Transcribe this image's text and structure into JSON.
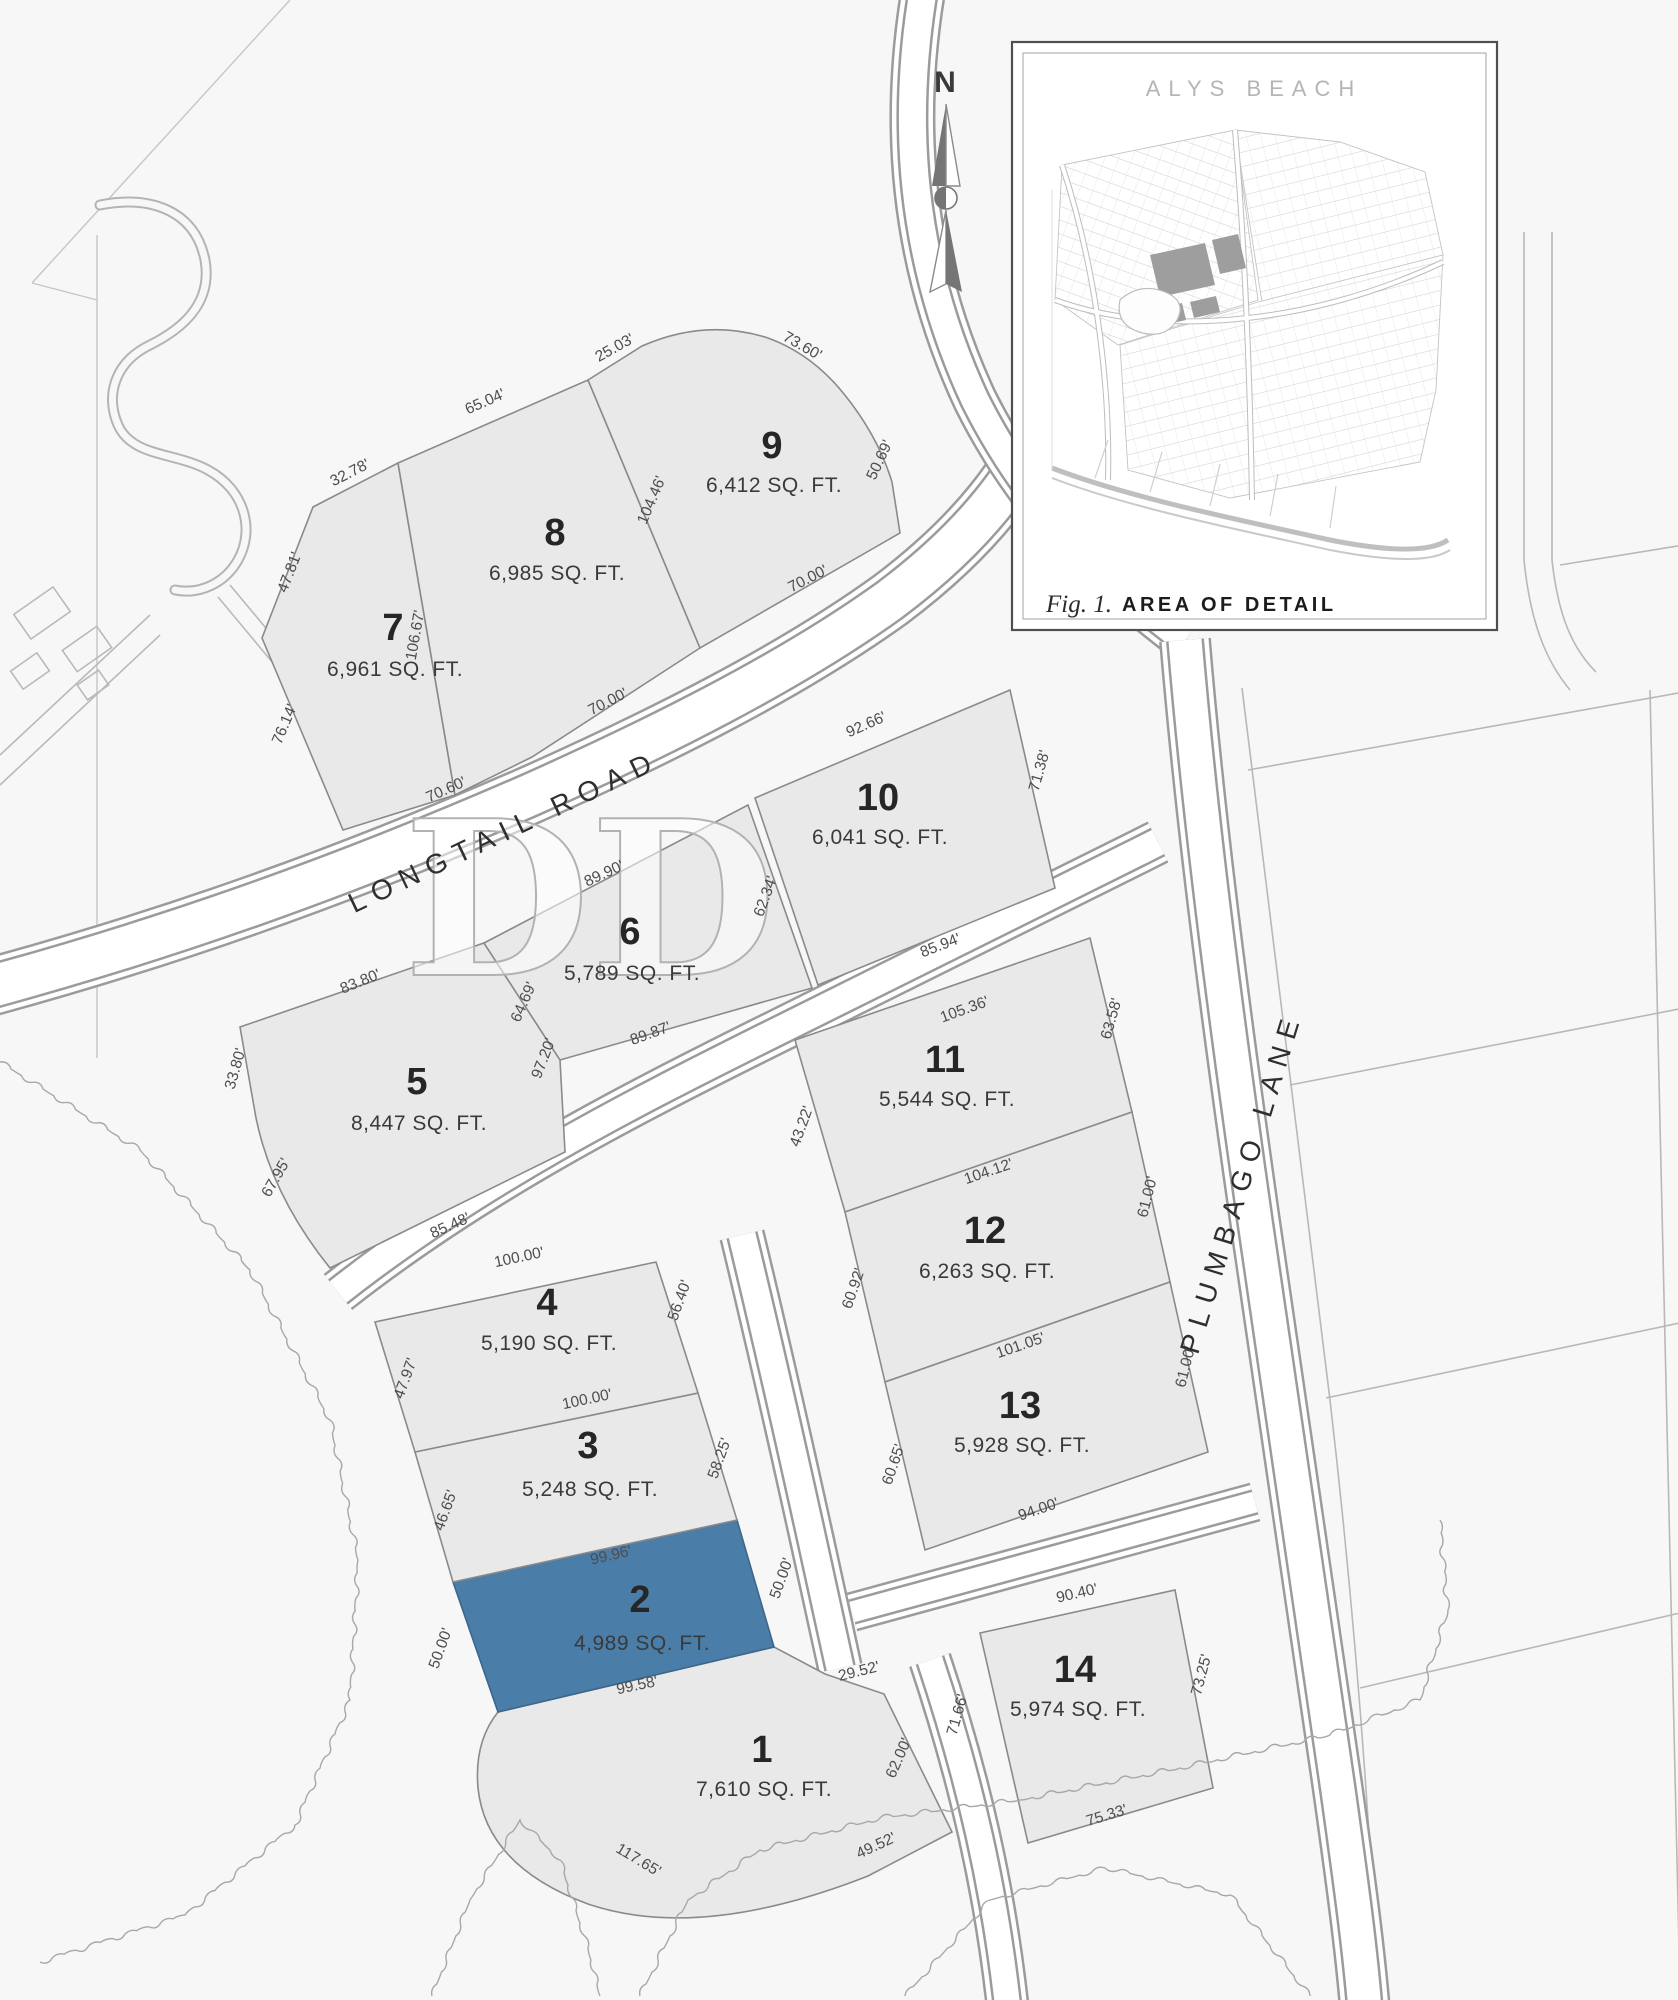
{
  "page": {
    "background": "#f7f7f7"
  },
  "compass": {
    "north_label": "N"
  },
  "watermark": {
    "text": "DD"
  },
  "streets": {
    "longtail": {
      "label": "LONGTAIL ROAD"
    },
    "plumbago": {
      "label": "PLUMBAGO LANE"
    }
  },
  "inset": {
    "title": "ALYS BEACH",
    "figure_label": "Fig. 1.",
    "caption": "AREA OF DETAIL"
  },
  "colors": {
    "highlight": "#4a7da8",
    "lot_fill": "#e9e9e9",
    "lot_stroke": "#8a8a8a",
    "highlight_num": "#20303e",
    "highlight_text": "#3a6080",
    "highlight_dim": "#3f658a"
  },
  "lots": [
    {
      "number": "1",
      "area": "7,610 SQ. FT.",
      "highlighted": false,
      "num_pos": [
        762,
        1762
      ],
      "area_pos": [
        764,
        1796
      ],
      "dims": [
        {
          "text": "117.65'",
          "x": 636,
          "y": 1864,
          "rot": 31
        },
        {
          "text": "49.52'",
          "x": 878,
          "y": 1850,
          "rot": -25
        },
        {
          "text": "62.00'",
          "x": 903,
          "y": 1760,
          "rot": -66
        },
        {
          "text": "29.52'",
          "x": 860,
          "y": 1676,
          "rot": -14
        }
      ]
    },
    {
      "number": "2",
      "area": "4,989 SQ. FT.",
      "highlighted": true,
      "num_pos": [
        640,
        1612
      ],
      "area_pos": [
        642,
        1650
      ],
      "dims": [
        {
          "text": "99.96'",
          "x": 612,
          "y": 1560,
          "rot": -13,
          "color": "#3f658a"
        },
        {
          "text": "50.00'",
          "x": 445,
          "y": 1650,
          "rot": -70,
          "color": "#3f658a"
        },
        {
          "text": "50.00'",
          "x": 786,
          "y": 1580,
          "rot": -70,
          "color": "#3f658a"
        },
        {
          "text": "99.58'",
          "x": 638,
          "y": 1690,
          "rot": -12
        }
      ]
    },
    {
      "number": "3",
      "area": "5,248 SQ. FT.",
      "highlighted": false,
      "num_pos": [
        588,
        1458
      ],
      "area_pos": [
        590,
        1496
      ],
      "dims": [
        {
          "text": "46.65'",
          "x": 450,
          "y": 1512,
          "rot": -70
        },
        {
          "text": "58.25'",
          "x": 724,
          "y": 1460,
          "rot": -70
        }
      ]
    },
    {
      "number": "4",
      "area": "5,190 SQ. FT.",
      "highlighted": false,
      "num_pos": [
        547,
        1315
      ],
      "area_pos": [
        549,
        1350
      ],
      "dims": [
        {
          "text": "100.00'",
          "x": 520,
          "y": 1262,
          "rot": -12
        },
        {
          "text": "47.97'",
          "x": 410,
          "y": 1380,
          "rot": -70
        },
        {
          "text": "100.00'",
          "x": 588,
          "y": 1404,
          "rot": -12
        },
        {
          "text": "56.40'",
          "x": 684,
          "y": 1302,
          "rot": -70
        }
      ]
    },
    {
      "number": "5",
      "area": "8,447 SQ. FT.",
      "highlighted": false,
      "num_pos": [
        417,
        1094
      ],
      "area_pos": [
        419,
        1130
      ],
      "dims": [
        {
          "text": "83.80'",
          "x": 362,
          "y": 986,
          "rot": -22
        },
        {
          "text": "33.80'",
          "x": 240,
          "y": 1070,
          "rot": -74
        },
        {
          "text": "67.95'",
          "x": 280,
          "y": 1180,
          "rot": -60
        },
        {
          "text": "85.48'",
          "x": 452,
          "y": 1230,
          "rot": -24
        },
        {
          "text": "97.20'",
          "x": 548,
          "y": 1060,
          "rot": -69
        }
      ]
    },
    {
      "number": "6",
      "area": "5,789 SQ. FT.",
      "highlighted": false,
      "num_pos": [
        630,
        944
      ],
      "area_pos": [
        632,
        980
      ],
      "dims": [
        {
          "text": "89.90'",
          "x": 606,
          "y": 878,
          "rot": -25
        },
        {
          "text": "64.69'",
          "x": 528,
          "y": 1004,
          "rot": -66
        },
        {
          "text": "89.87'",
          "x": 652,
          "y": 1038,
          "rot": -20
        }
      ]
    },
    {
      "number": "7",
      "area": "6,961 SQ. FT.",
      "highlighted": false,
      "num_pos": [
        393,
        640
      ],
      "area_pos": [
        395,
        676
      ],
      "dims": [
        {
          "text": "47.81'",
          "x": 294,
          "y": 574,
          "rot": -69
        },
        {
          "text": "32.78'",
          "x": 352,
          "y": 477,
          "rot": -27
        },
        {
          "text": "76.14'",
          "x": 289,
          "y": 726,
          "rot": -67
        },
        {
          "text": "70.60'",
          "x": 448,
          "y": 794,
          "rot": -24
        },
        {
          "text": "106.67'",
          "x": 420,
          "y": 636,
          "rot": -80
        }
      ]
    },
    {
      "number": "8",
      "area": "6,985 SQ. FT.",
      "highlighted": false,
      "num_pos": [
        555,
        545
      ],
      "area_pos": [
        557,
        580
      ],
      "dims": [
        {
          "text": "65.04'",
          "x": 487,
          "y": 406,
          "rot": -24
        },
        {
          "text": "104.46'",
          "x": 656,
          "y": 502,
          "rot": -67
        },
        {
          "text": "70.00'",
          "x": 610,
          "y": 706,
          "rot": -27
        }
      ]
    },
    {
      "number": "9",
      "area": "6,412 SQ. FT.",
      "highlighted": false,
      "num_pos": [
        772,
        458
      ],
      "area_pos": [
        774,
        492
      ],
      "dims": [
        {
          "text": "25.03'",
          "x": 617,
          "y": 352,
          "rot": -29
        },
        {
          "text": "73.60'",
          "x": 800,
          "y": 350,
          "rot": 30
        },
        {
          "text": "50.69'",
          "x": 884,
          "y": 462,
          "rot": -65
        },
        {
          "text": "70.00'",
          "x": 810,
          "y": 583,
          "rot": -27
        }
      ]
    },
    {
      "number": "10",
      "area": "6,041 SQ. FT.",
      "highlighted": false,
      "num_pos": [
        878,
        810
      ],
      "area_pos": [
        880,
        844
      ],
      "dims": [
        {
          "text": "92.66'",
          "x": 868,
          "y": 729,
          "rot": -24
        },
        {
          "text": "71.38'",
          "x": 1044,
          "y": 772,
          "rot": -74
        },
        {
          "text": "85.94'",
          "x": 942,
          "y": 950,
          "rot": -21
        },
        {
          "text": "62.34'",
          "x": 770,
          "y": 898,
          "rot": -70
        }
      ]
    },
    {
      "number": "11",
      "area": "5,544 SQ. FT.",
      "highlighted": false,
      "num_pos": [
        945,
        1072
      ],
      "area_pos": [
        947,
        1106
      ],
      "dims": [
        {
          "text": "105.36'",
          "x": 966,
          "y": 1014,
          "rot": -20
        },
        {
          "text": "63.58'",
          "x": 1116,
          "y": 1020,
          "rot": -74
        },
        {
          "text": "43.22'",
          "x": 806,
          "y": 1128,
          "rot": -70
        }
      ]
    },
    {
      "number": "12",
      "area": "6,263 SQ. FT.",
      "highlighted": false,
      "num_pos": [
        985,
        1243
      ],
      "area_pos": [
        987,
        1278
      ],
      "dims": [
        {
          "text": "104.12'",
          "x": 990,
          "y": 1176,
          "rot": -19
        },
        {
          "text": "61.00'",
          "x": 1152,
          "y": 1198,
          "rot": -76
        },
        {
          "text": "60.92'",
          "x": 858,
          "y": 1290,
          "rot": -71
        },
        {
          "text": "101.05'",
          "x": 1022,
          "y": 1350,
          "rot": -19
        }
      ]
    },
    {
      "number": "13",
      "area": "5,928 SQ. FT.",
      "highlighted": false,
      "num_pos": [
        1020,
        1418
      ],
      "area_pos": [
        1022,
        1452
      ],
      "dims": [
        {
          "text": "60.65'",
          "x": 898,
          "y": 1466,
          "rot": -71
        },
        {
          "text": "61.00'",
          "x": 1190,
          "y": 1368,
          "rot": -76
        },
        {
          "text": "94.00'",
          "x": 1040,
          "y": 1514,
          "rot": -19
        }
      ]
    },
    {
      "number": "14",
      "area": "5,974  SQ. FT.",
      "highlighted": false,
      "num_pos": [
        1075,
        1682
      ],
      "area_pos": [
        1078,
        1716
      ],
      "dims": [
        {
          "text": "90.40'",
          "x": 1078,
          "y": 1598,
          "rot": -13
        },
        {
          "text": "71.66'",
          "x": 962,
          "y": 1716,
          "rot": -74
        },
        {
          "text": "73.25'",
          "x": 1206,
          "y": 1676,
          "rot": -75
        },
        {
          "text": "75.33'",
          "x": 1108,
          "y": 1820,
          "rot": -17
        }
      ]
    }
  ]
}
